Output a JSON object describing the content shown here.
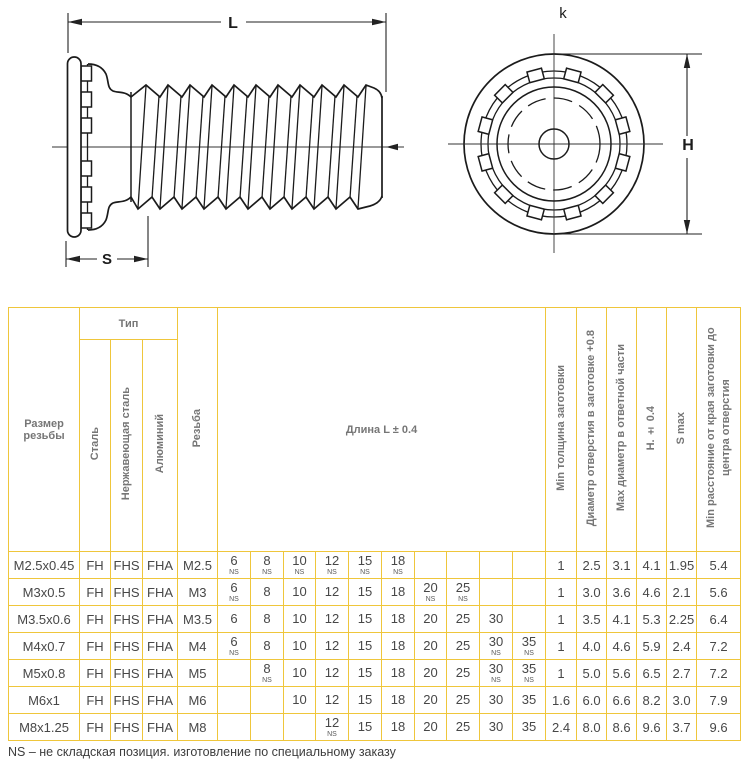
{
  "drawing": {
    "side_view": {
      "length_label": "L",
      "shoulder_label": "S"
    },
    "front_view": {
      "height_label": "H",
      "head_label": "k"
    }
  },
  "table": {
    "headers": {
      "size": "Размер резьбы",
      "type_group": "Тип",
      "type_steel": "Сталь",
      "type_stainless": "Нержавеющая сталь",
      "type_aluminum": "Алюминий",
      "thread": "Резьба",
      "length": "Длина L ± 0.4",
      "min_thickness": "Min толщина заготовки",
      "hole_diameter": "Диаметр отверстия в заготовке +0.8",
      "max_diameter": "Max диаметр в ответной части",
      "h_tol": "H. ± 0.4",
      "s_max": "S max",
      "min_distance": "Min расстояние от края заготовки до центра отверстия"
    },
    "ns_label": "NS",
    "rows": [
      {
        "size": "M2.5x0.45",
        "steel": "FH",
        "stainless": "FHS",
        "aluminum": "FHA",
        "thread": "M2.5",
        "lengths": [
          {
            "v": "6",
            "ns": true
          },
          {
            "v": "8",
            "ns": true
          },
          {
            "v": "10",
            "ns": true
          },
          {
            "v": "12",
            "ns": true
          },
          {
            "v": "15",
            "ns": true
          },
          {
            "v": "18",
            "ns": true
          },
          {
            "v": "",
            "ns": false
          },
          {
            "v": "",
            "ns": false
          },
          {
            "v": "",
            "ns": false
          },
          {
            "v": "",
            "ns": false
          }
        ],
        "min_thickness": "1",
        "hole_diameter": "2.5",
        "max_diameter": "3.1",
        "h": "4.1",
        "s_max": "1.95",
        "min_distance": "5.4"
      },
      {
        "size": "M3x0.5",
        "steel": "FH",
        "stainless": "FHS",
        "aluminum": "FHA",
        "thread": "M3",
        "lengths": [
          {
            "v": "6",
            "ns": true
          },
          {
            "v": "8",
            "ns": false
          },
          {
            "v": "10",
            "ns": false
          },
          {
            "v": "12",
            "ns": false
          },
          {
            "v": "15",
            "ns": false
          },
          {
            "v": "18",
            "ns": false
          },
          {
            "v": "20",
            "ns": true
          },
          {
            "v": "25",
            "ns": true
          },
          {
            "v": "",
            "ns": false
          },
          {
            "v": "",
            "ns": false
          }
        ],
        "min_thickness": "1",
        "hole_diameter": "3.0",
        "max_diameter": "3.6",
        "h": "4.6",
        "s_max": "2.1",
        "min_distance": "5.6"
      },
      {
        "size": "M3.5x0.6",
        "steel": "FH",
        "stainless": "FHS",
        "aluminum": "FHA",
        "thread": "M3.5",
        "lengths": [
          {
            "v": "6",
            "ns": false
          },
          {
            "v": "8",
            "ns": false
          },
          {
            "v": "10",
            "ns": false
          },
          {
            "v": "12",
            "ns": false
          },
          {
            "v": "15",
            "ns": false
          },
          {
            "v": "18",
            "ns": false
          },
          {
            "v": "20",
            "ns": false
          },
          {
            "v": "25",
            "ns": false
          },
          {
            "v": "30",
            "ns": false
          },
          {
            "v": "",
            "ns": false
          }
        ],
        "min_thickness": "1",
        "hole_diameter": "3.5",
        "max_diameter": "4.1",
        "h": "5.3",
        "s_max": "2.25",
        "min_distance": "6.4"
      },
      {
        "size": "M4x0.7",
        "steel": "FH",
        "stainless": "FHS",
        "aluminum": "FHA",
        "thread": "M4",
        "lengths": [
          {
            "v": "6",
            "ns": true
          },
          {
            "v": "8",
            "ns": false
          },
          {
            "v": "10",
            "ns": false
          },
          {
            "v": "12",
            "ns": false
          },
          {
            "v": "15",
            "ns": false
          },
          {
            "v": "18",
            "ns": false
          },
          {
            "v": "20",
            "ns": false
          },
          {
            "v": "25",
            "ns": false
          },
          {
            "v": "30",
            "ns": true
          },
          {
            "v": "35",
            "ns": true
          }
        ],
        "min_thickness": "1",
        "hole_diameter": "4.0",
        "max_diameter": "4.6",
        "h": "5.9",
        "s_max": "2.4",
        "min_distance": "7.2"
      },
      {
        "size": "M5x0.8",
        "steel": "FH",
        "stainless": "FHS",
        "aluminum": "FHA",
        "thread": "M5",
        "lengths": [
          {
            "v": "",
            "ns": false
          },
          {
            "v": "8",
            "ns": true
          },
          {
            "v": "10",
            "ns": false
          },
          {
            "v": "12",
            "ns": false
          },
          {
            "v": "15",
            "ns": false
          },
          {
            "v": "18",
            "ns": false
          },
          {
            "v": "20",
            "ns": false
          },
          {
            "v": "25",
            "ns": false
          },
          {
            "v": "30",
            "ns": true
          },
          {
            "v": "35",
            "ns": true
          }
        ],
        "min_thickness": "1",
        "hole_diameter": "5.0",
        "max_diameter": "5.6",
        "h": "6.5",
        "s_max": "2.7",
        "min_distance": "7.2"
      },
      {
        "size": "M6x1",
        "steel": "FH",
        "stainless": "FHS",
        "aluminum": "FHA",
        "thread": "M6",
        "lengths": [
          {
            "v": "",
            "ns": false
          },
          {
            "v": "",
            "ns": false
          },
          {
            "v": "10",
            "ns": false
          },
          {
            "v": "12",
            "ns": false
          },
          {
            "v": "15",
            "ns": false
          },
          {
            "v": "18",
            "ns": false
          },
          {
            "v": "20",
            "ns": false
          },
          {
            "v": "25",
            "ns": false
          },
          {
            "v": "30",
            "ns": false
          },
          {
            "v": "35",
            "ns": false
          }
        ],
        "min_thickness": "1.6",
        "hole_diameter": "6.0",
        "max_diameter": "6.6",
        "h": "8.2",
        "s_max": "3.0",
        "min_distance": "7.9"
      },
      {
        "size": "M8x1.25",
        "steel": "FH",
        "stainless": "FHS",
        "aluminum": "FHA",
        "thread": "M8",
        "lengths": [
          {
            "v": "",
            "ns": false
          },
          {
            "v": "",
            "ns": false
          },
          {
            "v": "",
            "ns": false
          },
          {
            "v": "12",
            "ns": true
          },
          {
            "v": "15",
            "ns": false
          },
          {
            "v": "18",
            "ns": false
          },
          {
            "v": "20",
            "ns": false
          },
          {
            "v": "25",
            "ns": false
          },
          {
            "v": "30",
            "ns": false
          },
          {
            "v": "35",
            "ns": false
          }
        ],
        "min_thickness": "2.4",
        "hole_diameter": "8.0",
        "max_diameter": "8.6",
        "h": "9.6",
        "s_max": "3.7",
        "min_distance": "9.6"
      }
    ],
    "footnote": "NS – не складская позиция. изготовление по специальному заказу"
  },
  "colors": {
    "table_border": "#EFC63B",
    "header_text": "#767676",
    "cell_text": "#474747",
    "line": "#1B1B1B"
  }
}
